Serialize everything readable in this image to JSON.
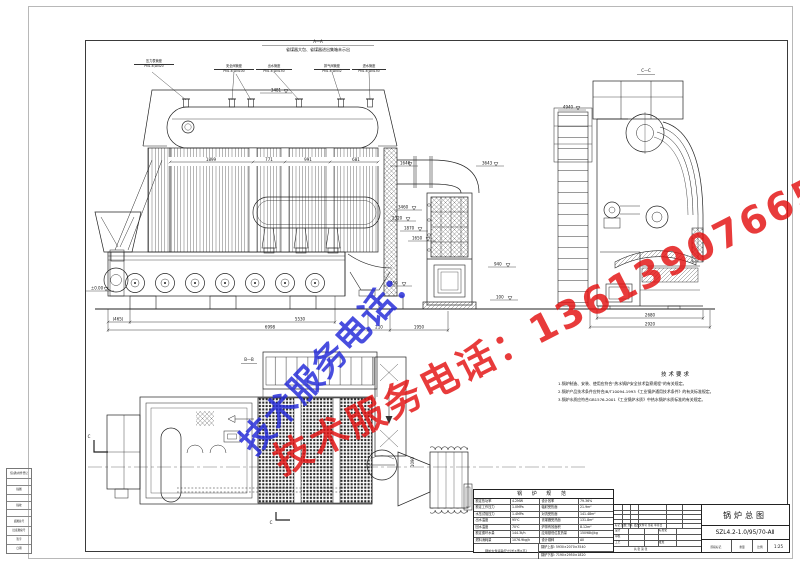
{
  "watermark": {
    "label": "技术服务电话：",
    "number": "13613907665",
    "blue": "#2228d8",
    "red": "#e31111"
  },
  "view_aa": {
    "title": "A—A",
    "subtitle": "省煤器大包、省煤器进出集箱未示出",
    "nozzles": [
      {
        "name": "压力表管座",
        "spec": "PN1.6;DN20"
      },
      {
        "name": "安全阀管座",
        "spec": "PN1.6;DN100"
      },
      {
        "name": "出水管座",
        "spec": "PN1.6;DN150"
      },
      {
        "name": "排气阀管座",
        "spec": "PN1.6;DN32"
      },
      {
        "name": "进水管座",
        "spec": "PN1.6;DN150"
      }
    ],
    "dims_top": [
      "1899",
      "771",
      "991",
      "681"
    ],
    "dims_bottom": [
      "(465)",
      "5530",
      "6998",
      "210",
      "1950"
    ],
    "levels_right": [
      "1640",
      "3643",
      "3460",
      "2320",
      "1870",
      "1650",
      "940",
      "450",
      "100"
    ],
    "dim_left": "3481",
    "level_zero": "±0.00"
  },
  "view_cc": {
    "title": "C—C",
    "level": "4940",
    "dim_inner": "2680",
    "dim_outer": "2920"
  },
  "view_bb": {
    "title": "B—B",
    "dim": "1090",
    "cut_mark": "C"
  },
  "tech_notes": {
    "title": "技术要求",
    "lines": [
      "1.锅炉制造、安装、使用应符合“热水锅炉安全技术监察规程”的有关规定。",
      "2.锅炉产品技术条件应符合JB/T10094-1993《工业锅炉通用技术条件》的有关标准规定。",
      "3.锅炉水质应符合GB1576-2001《工业锅炉水质》中热水锅炉水质标准的有关规定。"
    ]
  },
  "spec_table": {
    "title": "锅 炉 规 范",
    "rows": [
      [
        "额定热功率",
        "4.2MW",
        "设计效率",
        "79.36%"
      ],
      [
        "额定工作压力",
        "1.0MPa",
        "辐射受热面",
        "21.9m²"
      ],
      [
        "水压试验压力",
        "1.4MPa",
        "对流受热面",
        "141.48m²"
      ],
      [
        "出水温度",
        "95℃",
        "省煤器受热面",
        "131.8m²"
      ],
      [
        "回水温度",
        "70℃",
        "炉排有效面积",
        "8.12m²"
      ],
      [
        "额定循环水量",
        "144.3t/h",
        "应用基低位发热量",
        "15098kJ/kg"
      ],
      [
        "燃料消耗量",
        "1076.9kg/h",
        "设计煤种",
        "AⅡ"
      ]
    ],
    "transport_label": "锅炉大件运输尺寸(长×宽×高)",
    "transport_upper": "锅炉上部: 5930×2070×3540",
    "transport_lower": "锅炉下部: 7190×2950×1820"
  },
  "title_block": {
    "drawing_title": "锅炉总图",
    "model": "SZL4.2-1.0/95/70-AⅡ",
    "rev_header": "标记 处数 分区 更改文件号 签名 年月日",
    "sign_labels": [
      "设计",
      "审核",
      "工艺"
    ],
    "right_labels": [
      "标准化",
      "批准"
    ],
    "stage_label": "阶段标记",
    "weight_label": "重量",
    "scale_label": "比例",
    "scale": "1:25",
    "sheet_info": "共 张 第 张"
  },
  "margin_blocks": [
    "借(通)用件登记",
    "描图",
    "描校",
    "底图总号",
    "旧底图总号",
    "签字",
    "日期"
  ]
}
